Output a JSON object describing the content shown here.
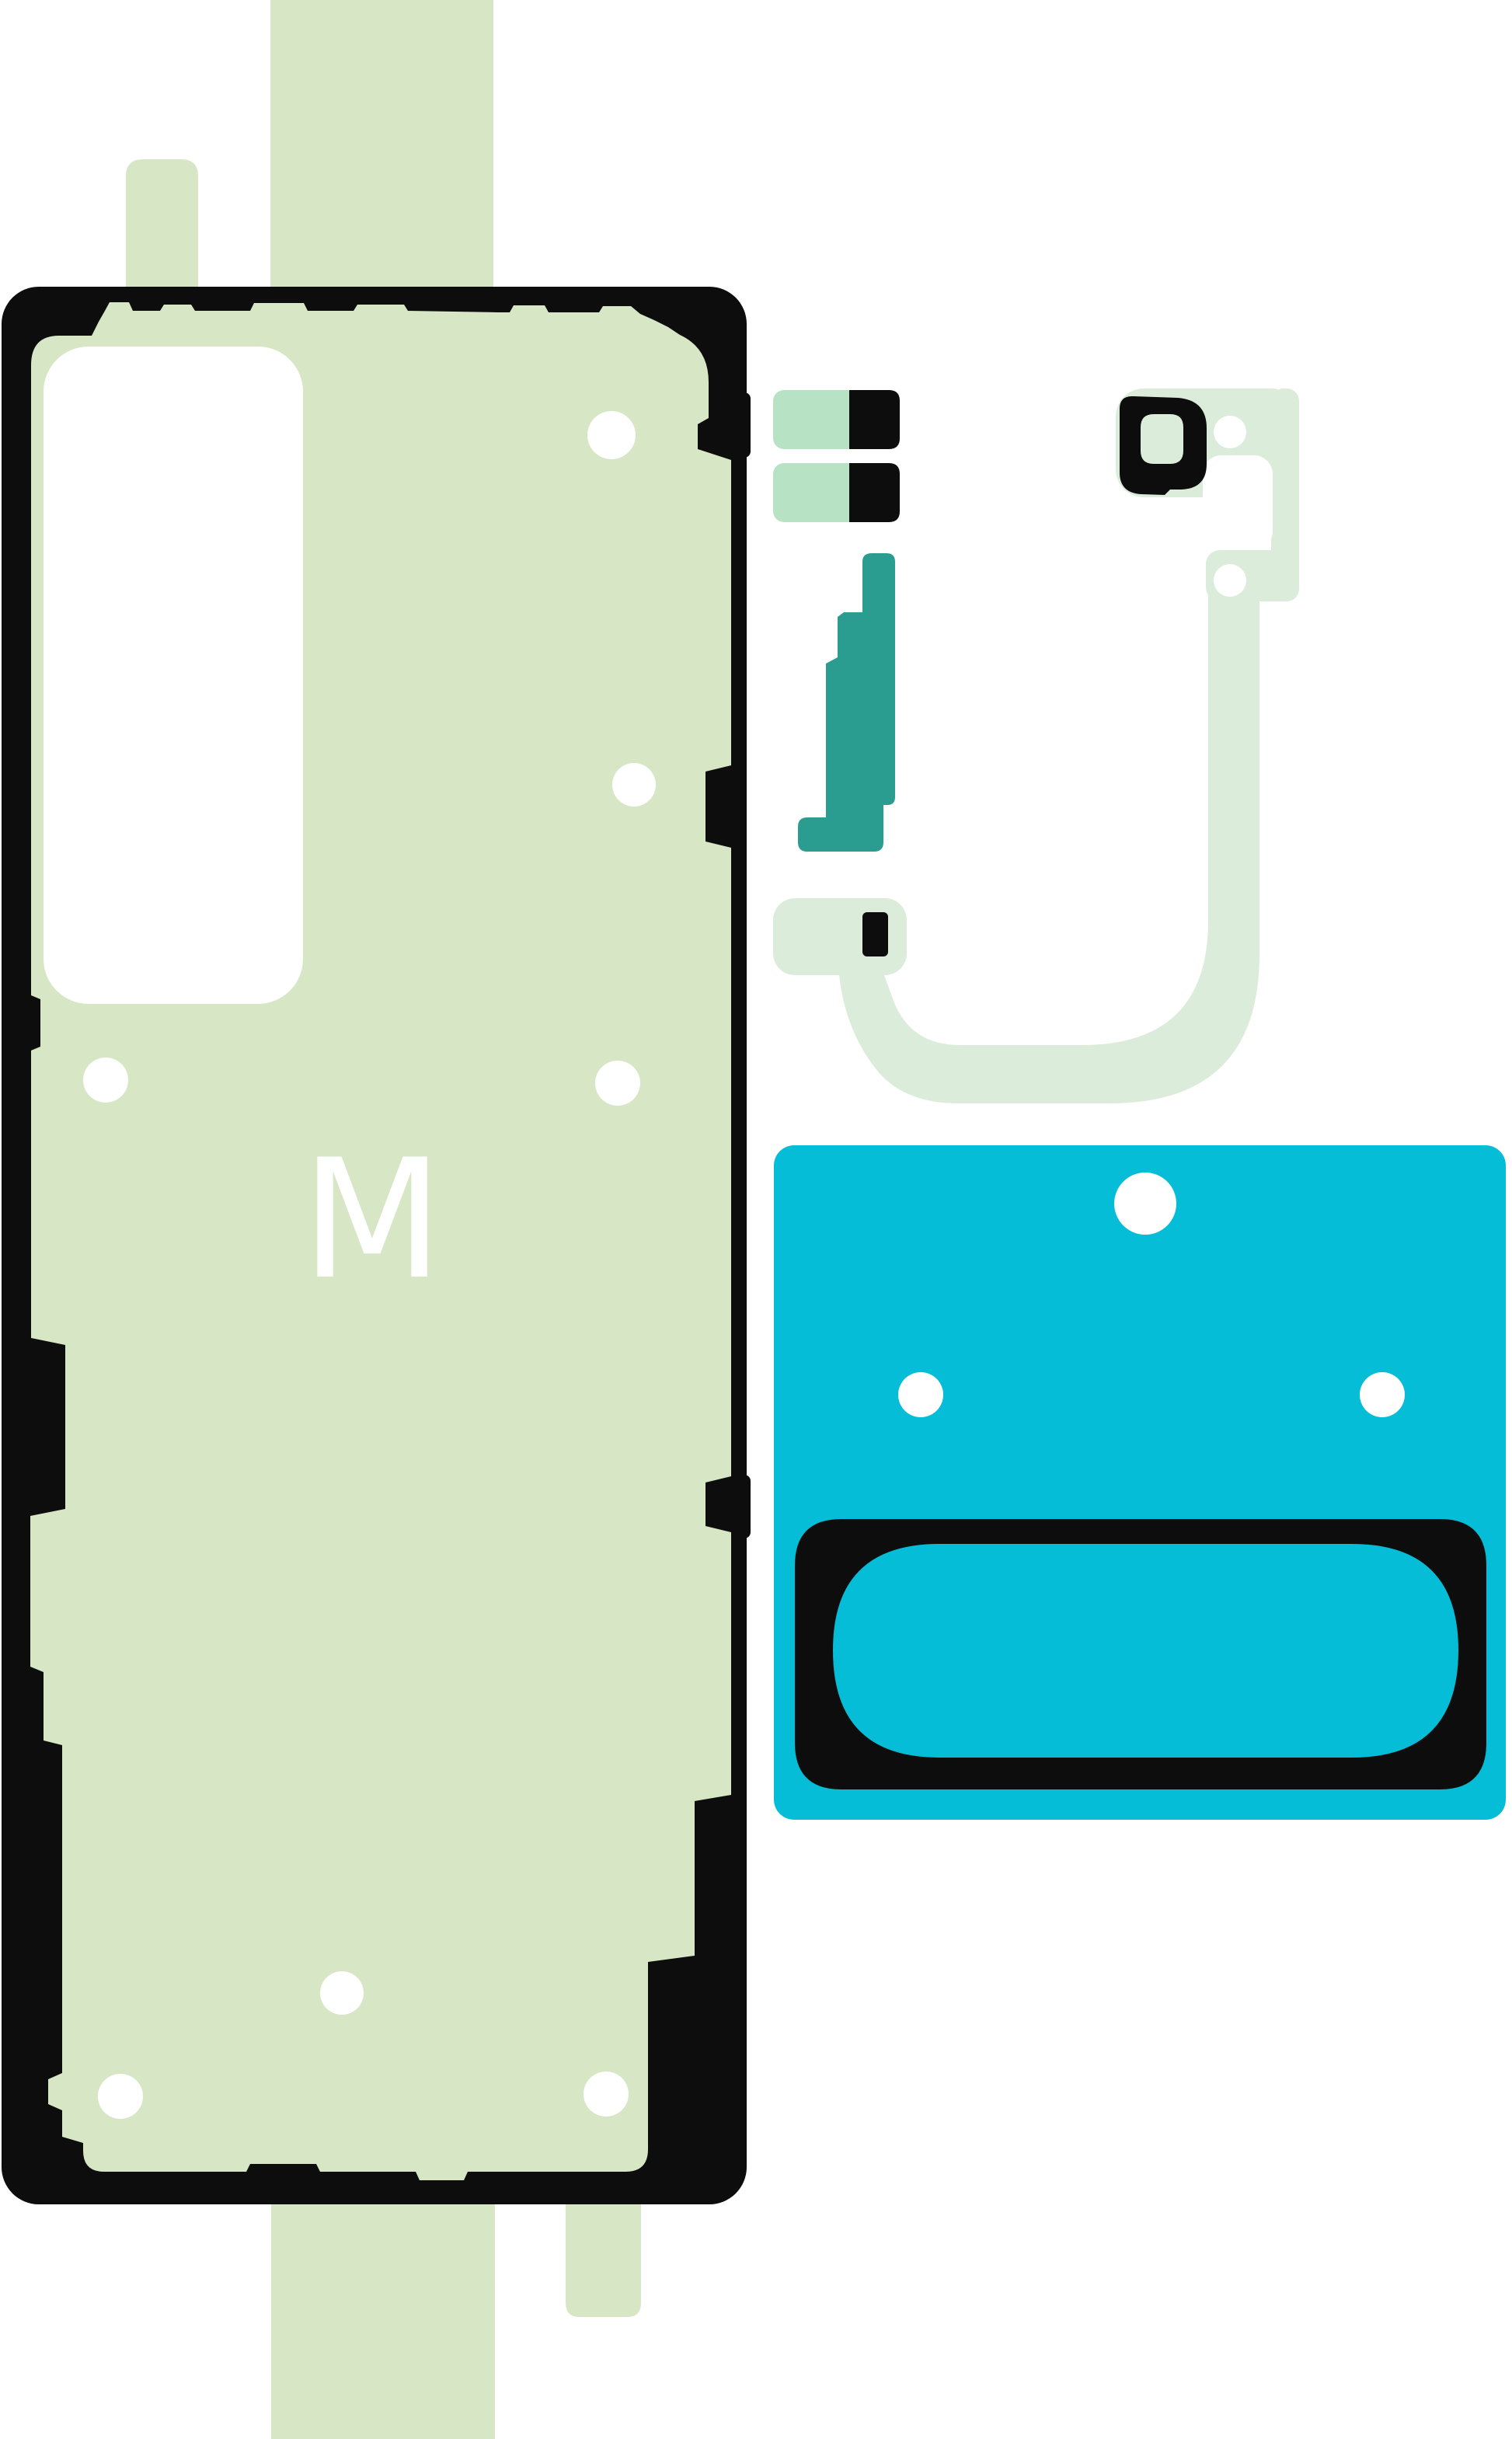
{
  "label": {
    "text": "M"
  },
  "colors": {
    "green": "#d7e7c6",
    "pale-green": "#dcecdb",
    "mint": "#b7e3c4",
    "teal": "#2a9c90",
    "cyan": "#05bdd7",
    "ink": "#0d0d0d",
    "white": "#ffffff",
    "label": "#ffffff"
  }
}
